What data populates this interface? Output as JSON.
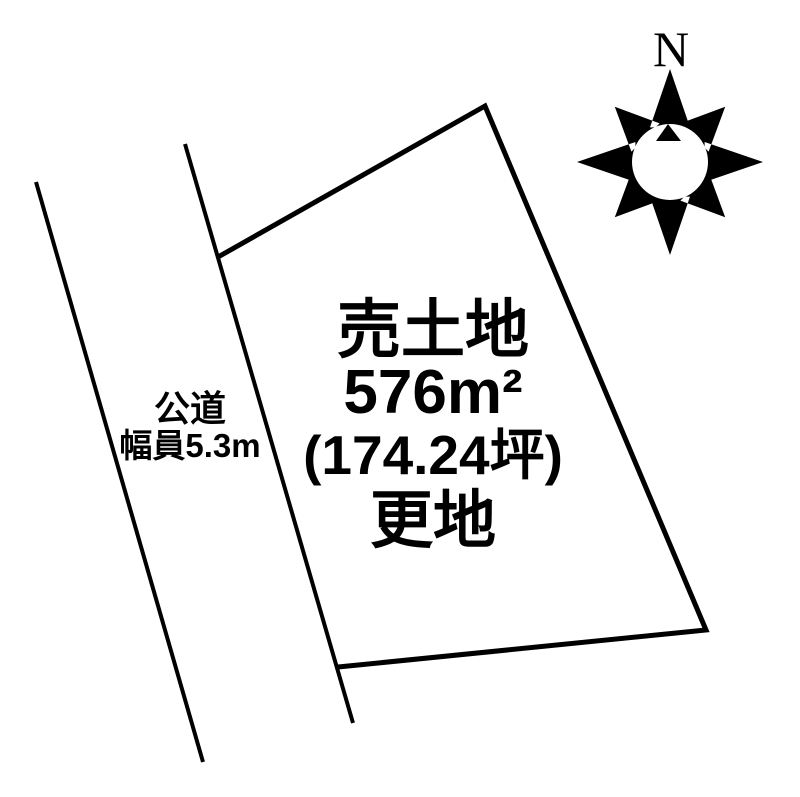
{
  "figure": {
    "background_color": "#ffffff",
    "line_color": "#000000"
  },
  "compass": {
    "label": "N"
  },
  "road": {
    "name": "公道",
    "width_label": "幅員5.3m"
  },
  "plot": {
    "title": "売土地",
    "area_sqm": "576m²",
    "area_tsubo": "(174.24坪)",
    "condition": "更地"
  }
}
